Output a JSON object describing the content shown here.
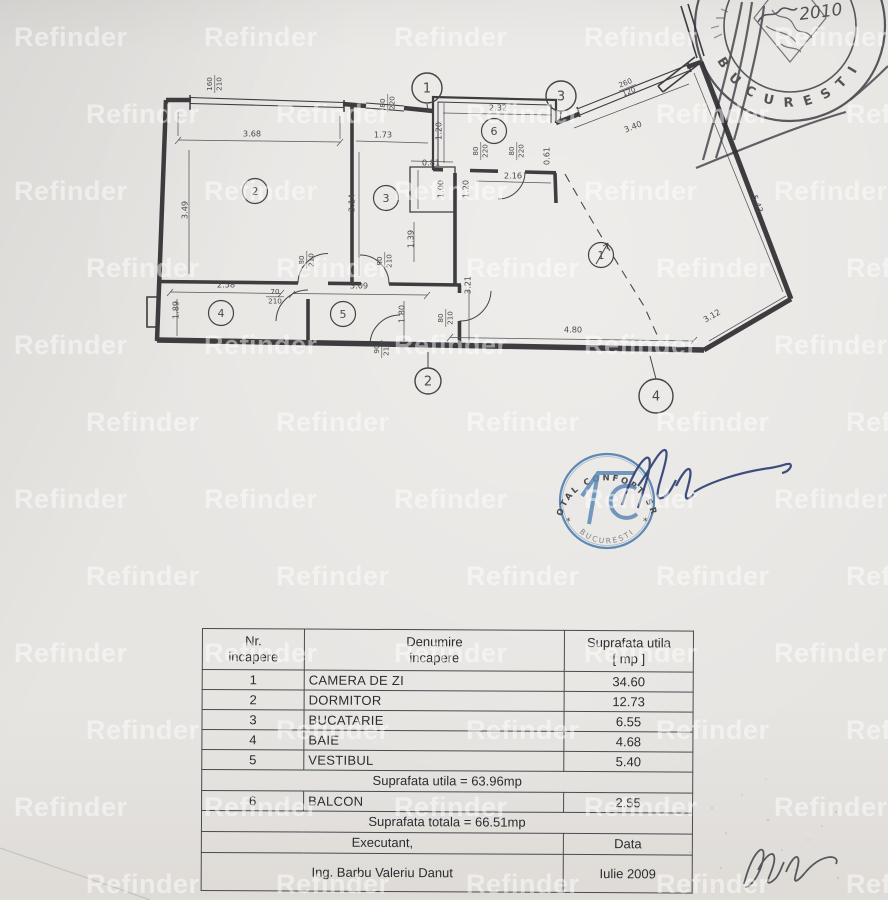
{
  "watermark": {
    "text": "Refinder"
  },
  "floor_plan": {
    "room_markers": [
      {
        "n": "1",
        "x": 601,
        "y": 255
      },
      {
        "n": "2",
        "x": 255,
        "y": 191
      },
      {
        "n": "3",
        "x": 386,
        "y": 198
      },
      {
        "n": "4",
        "x": 221,
        "y": 313
      },
      {
        "n": "5",
        "x": 343,
        "y": 314
      },
      {
        "n": "6",
        "x": 494,
        "y": 131
      }
    ],
    "axis_markers": [
      {
        "n": "1",
        "x": 427,
        "y": 88,
        "r": 15
      },
      {
        "n": "2",
        "x": 428,
        "y": 381,
        "r": 13
      },
      {
        "n": "3",
        "x": 561,
        "y": 96,
        "r": 15
      },
      {
        "n": "4",
        "x": 656,
        "y": 396,
        "r": 17
      }
    ],
    "dimension_labels": [
      {
        "t": "160",
        "t2": "210",
        "x": 214,
        "y": 84,
        "r": -90
      },
      {
        "t": "3.68",
        "x": 252,
        "y": 134,
        "r": 0
      },
      {
        "t": "3.49",
        "x": 185,
        "y": 210,
        "r": -90
      },
      {
        "t": "80",
        "t2": "220",
        "x": 387,
        "y": 103,
        "r": -90
      },
      {
        "t": "1.73",
        "x": 383,
        "y": 135,
        "r": 0
      },
      {
        "t": "3.14",
        "x": 352,
        "y": 203,
        "r": -90
      },
      {
        "t": "2.32",
        "x": 498,
        "y": 108,
        "r": 0
      },
      {
        "t": "1.20",
        "x": 439,
        "y": 131,
        "r": -90
      },
      {
        "t": "80",
        "t2": "220",
        "x": 480,
        "y": 151,
        "r": -90
      },
      {
        "t": "80",
        "t2": "220",
        "x": 516,
        "y": 151,
        "r": -90
      },
      {
        "t": "0.61",
        "x": 547,
        "y": 156,
        "r": -90
      },
      {
        "t": "2.16",
        "x": 513,
        "y": 176,
        "r": 0
      },
      {
        "t": "0.81",
        "x": 431,
        "y": 163,
        "r": 0
      },
      {
        "t": "1.00",
        "x": 441,
        "y": 189,
        "r": -90
      },
      {
        "t": "1.20",
        "x": 466,
        "y": 189,
        "r": -90
      },
      {
        "t": "1.39",
        "x": 411,
        "y": 239,
        "r": -90
      },
      {
        "t": "80",
        "t2": "210",
        "x": 384,
        "y": 261,
        "r": -90
      },
      {
        "t": "80",
        "t2": "210",
        "x": 306,
        "y": 260,
        "r": -90
      },
      {
        "t": "2.58",
        "x": 226,
        "y": 285,
        "r": 0
      },
      {
        "t": "1.89",
        "x": 176,
        "y": 310,
        "r": -90
      },
      {
        "t": "70",
        "t2": "210",
        "x": 275,
        "y": 296,
        "r": 0
      },
      {
        "t": "3.09",
        "x": 359,
        "y": 286,
        "r": 0
      },
      {
        "t": "1.80",
        "x": 402,
        "y": 314,
        "r": -90
      },
      {
        "t": "90",
        "t2": "210",
        "x": 381,
        "y": 349,
        "r": -90
      },
      {
        "t": "80",
        "t2": "210",
        "x": 445,
        "y": 318,
        "r": -90
      },
      {
        "t": "3.21",
        "x": 468,
        "y": 285,
        "r": -90
      },
      {
        "t": "3.40",
        "x": 633,
        "y": 127,
        "r": -22
      },
      {
        "t": "260",
        "t2": "120",
        "x": 627,
        "y": 87,
        "r": -22
      },
      {
        "t": "5.43",
        "x": 757,
        "y": 204,
        "r": 69
      },
      {
        "t": "3.12",
        "x": 712,
        "y": 316,
        "r": -30
      },
      {
        "t": "4.80",
        "x": 573,
        "y": 330,
        "r": 0
      }
    ]
  },
  "stamps": {
    "city_stamp": {
      "bottom_arc": "BUCURESTI",
      "handwritten_year": "2010"
    },
    "company_stamp": {
      "top_arc": "TOTAL CONFORT SRL",
      "bottom_arc": "BUCURESTI",
      "monogram": "TC",
      "side_mark": "*"
    }
  },
  "area_table": {
    "columns": [
      {
        "l1": "Nr.",
        "l2": "incapere"
      },
      {
        "l1": "Denumire",
        "l2": "incapere"
      },
      {
        "l1": "Suprafata utila",
        "l2": "[ mp ]"
      }
    ],
    "rows": [
      {
        "type": "room",
        "nr": "1",
        "name": "CAMERA DE ZI",
        "area": "34.60"
      },
      {
        "type": "room",
        "nr": "2",
        "name": "DORMITOR",
        "area": "12.73"
      },
      {
        "type": "room",
        "nr": "3",
        "name": "BUCATARIE",
        "area": "6.55"
      },
      {
        "type": "room",
        "nr": "4",
        "name": "BAIE",
        "area": "4.68"
      },
      {
        "type": "room",
        "nr": "5",
        "name": "VESTIBUL",
        "area": "5.40"
      },
      {
        "type": "summary",
        "text": "Suprafata utila = 63.96mp"
      },
      {
        "type": "room",
        "nr": "6",
        "name": "BALCON",
        "area": "2.55"
      },
      {
        "type": "summary",
        "text": "Suprafata totala = 66.51mp"
      },
      {
        "type": "footer",
        "left": "Executant,",
        "right": "Data"
      },
      {
        "type": "footer_tall",
        "left": "Ing. Barbu Valeriu Danut",
        "right": "Iulie 2009"
      }
    ]
  }
}
